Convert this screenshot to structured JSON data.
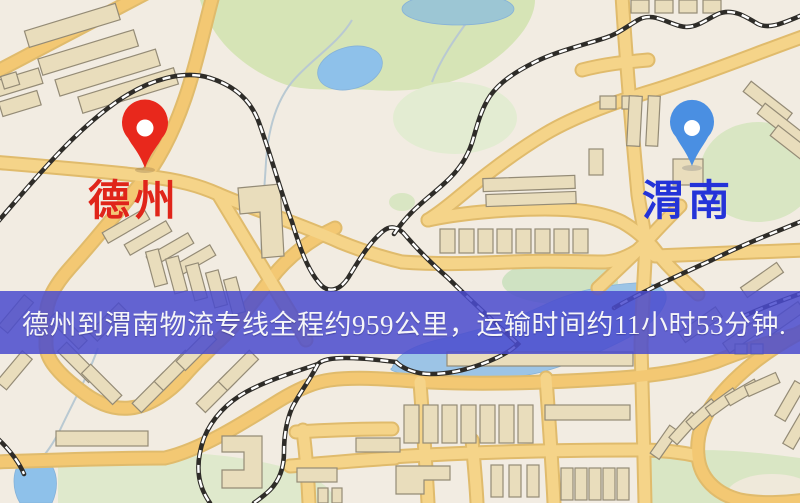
{
  "map": {
    "markers": [
      {
        "id": "origin",
        "label": "德州",
        "icon": "red-location-pin-icon",
        "pin_color": "#e8281c",
        "label_color": "#e0251a"
      },
      {
        "id": "destination",
        "label": "渭南",
        "icon": "blue-location-pin-icon",
        "pin_color": "#4a8fe2",
        "label_color": "#2433d8"
      }
    ],
    "banner": {
      "text": "德州到渭南物流专线全程约959公里，运输时间约11小时53分钟.",
      "background_color": "#4a4bce",
      "text_color": "#f5f5f8"
    },
    "route_facts": {
      "origin": "德州",
      "destination": "渭南",
      "distance_text": "约959公里",
      "duration_text": "约11小时53分钟"
    }
  }
}
